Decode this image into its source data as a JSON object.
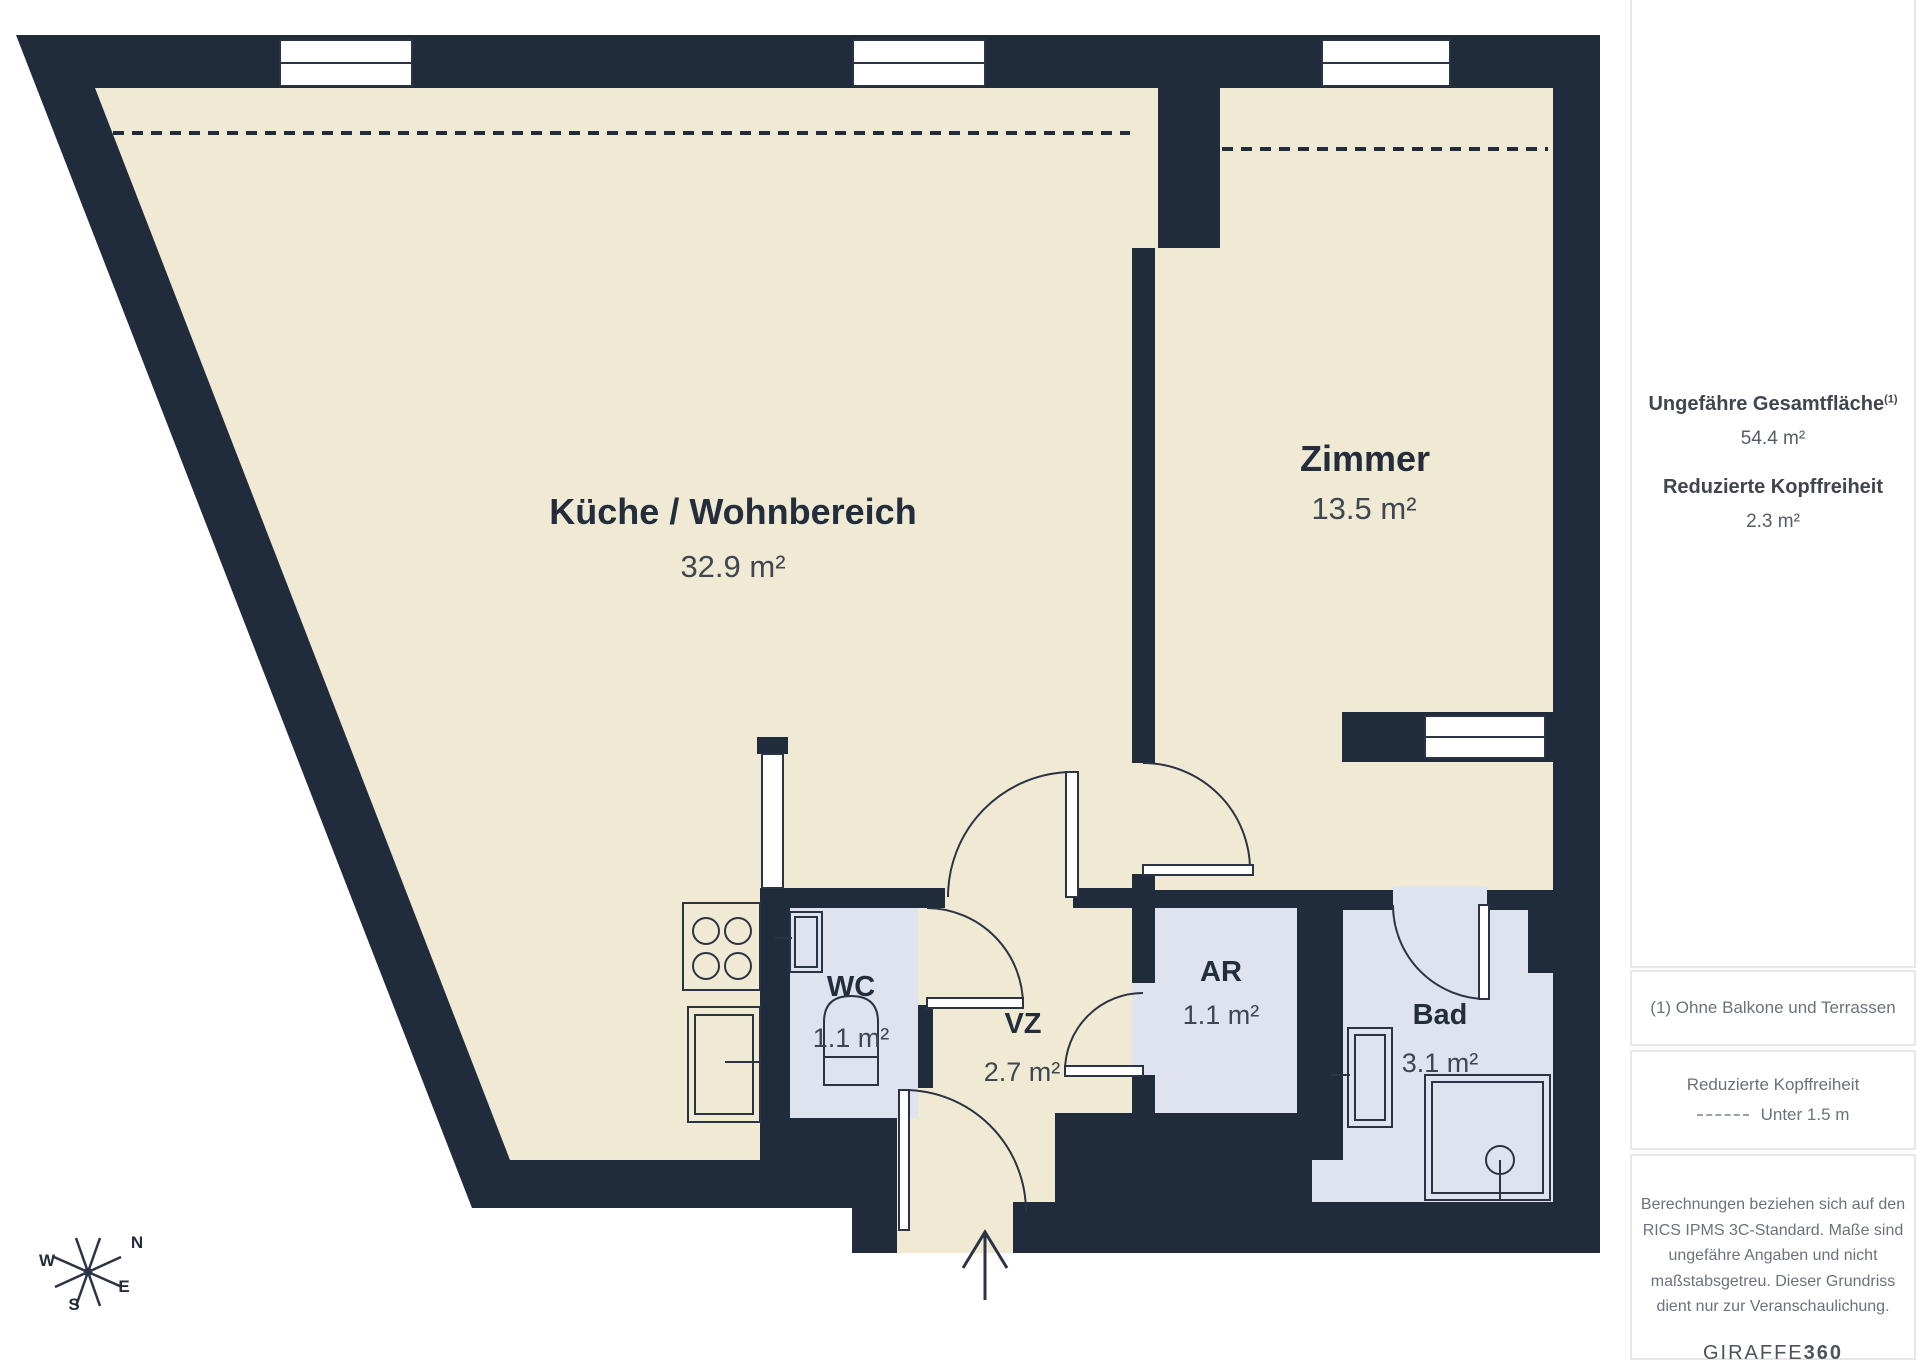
{
  "plan": {
    "rooms": [
      {
        "id": "kueche",
        "name": "Küche / Wohnbereich",
        "area": "32.9 m²"
      },
      {
        "id": "zimmer",
        "name": "Zimmer",
        "area": "13.5 m²"
      },
      {
        "id": "wc",
        "name": "WC",
        "area": "1.1 m²"
      },
      {
        "id": "vz",
        "name": "VZ",
        "area": "2.7 m²"
      },
      {
        "id": "ar",
        "name": "AR",
        "area": "1.1 m²"
      },
      {
        "id": "bad",
        "name": "Bad",
        "area": "3.1 m²"
      }
    ],
    "compass": {
      "n": "N",
      "e": "E",
      "s": "S",
      "w": "W"
    },
    "colors": {
      "wall": "#202b3b",
      "floor": "#f0ead5",
      "wet": "#dfe3ef"
    }
  },
  "sidebar": {
    "total_label": "Ungefähre Gesamtfläche",
    "total_sup": "(1)",
    "total_value": "54.4 m²",
    "reduced_label": "Reduzierte Kopffreiheit",
    "reduced_value": "2.3 m²",
    "footnote": "(1) Ohne Balkone und Terrassen",
    "legend_title": "Reduzierte Kopffreiheit",
    "legend_value": "Unter 1.5 m",
    "disclaimer": "Berechnungen beziehen sich auf den RICS IPMS 3C-Standard. Maße sind ungefähre Angaben und nicht maßstabsgetreu. Dieser Grundriss dient nur zur Veranschaulichung.",
    "brand": "GIRAFFE",
    "brand_bold": "360"
  }
}
